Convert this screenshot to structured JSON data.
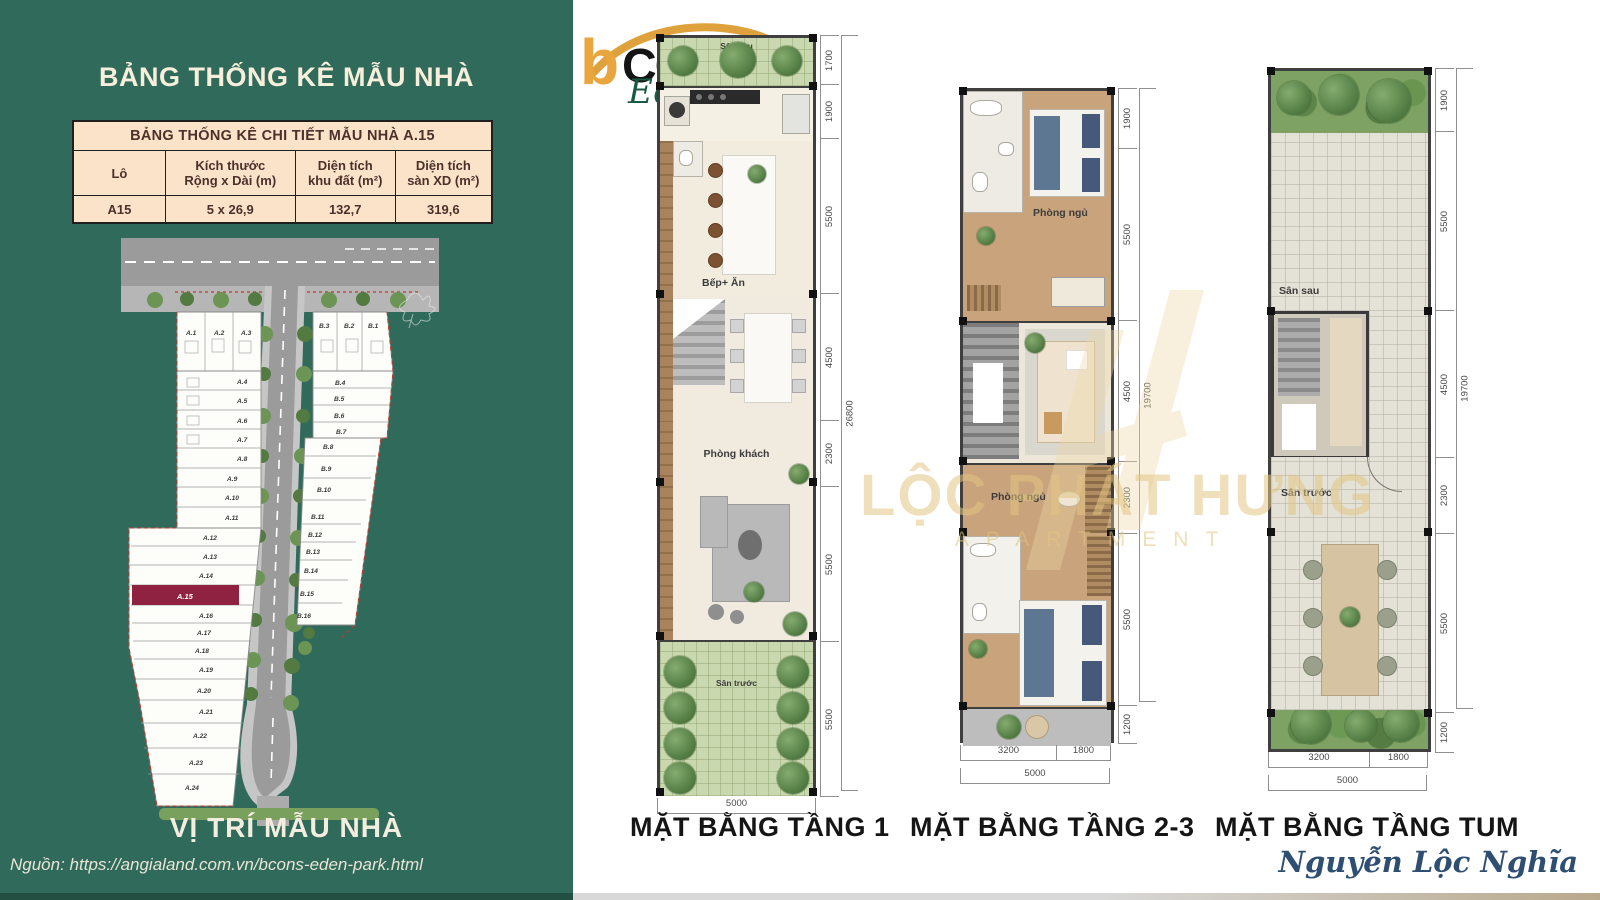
{
  "header": {
    "title": "BẢNG THỐNG KÊ MẪU NHÀ"
  },
  "table": {
    "title": "BẢNG THỐNG KÊ CHI TIẾT MẪU NHÀ A.15",
    "headers": [
      "Lô",
      "Kích thước\nRộng x Dài (m)",
      "Diện tích\nkhu đất (m²)",
      "Diện tích\nsàn XD (m²)"
    ],
    "row": [
      "A15",
      "5 x 26,9",
      "132,7",
      "319,6"
    ]
  },
  "siteplan": {
    "caption": "VỊ TRÍ MẪU NHÀ",
    "source": "Nguồn: https://angialand.com.vn/bcons-eden-park.html",
    "highlight_lot": "A.15",
    "highlight_color": "#8E2240",
    "lots_a": [
      "A.1",
      "A.2",
      "A.3",
      "A.4",
      "A.5",
      "A.6",
      "A.7",
      "A.8",
      "A.9",
      "A.10",
      "A.11",
      "A.12",
      "A.13",
      "A.14",
      "A.15",
      "A.16",
      "A.17",
      "A.18",
      "A.19",
      "A.20",
      "A.21",
      "A.22",
      "A.23",
      "A.24"
    ],
    "lots_b": [
      "B.1",
      "B.2",
      "B.3",
      "B.4",
      "B.5",
      "B.6",
      "B.7",
      "B.8",
      "B.9",
      "B.10",
      "B.11",
      "B.12",
      "B.13",
      "B.14",
      "B.15",
      "B.16"
    ]
  },
  "logo": {
    "b": "b",
    "name": "CONS",
    "subtitle": "Eden park"
  },
  "plans": [
    {
      "label": "MẶT BẰNG TẦNG 1",
      "rooms": {
        "san_sau": "Sân sau",
        "bep_an": "Bếp+ Ăn",
        "phong_khach": "Phòng khách",
        "san_truoc": "Sân trước"
      },
      "dims_right": [
        "1700",
        "1900",
        "5500",
        "4500",
        "2300",
        "5500",
        "5500"
      ],
      "dim_total": "26800",
      "dims_bottom": [
        "5000"
      ]
    },
    {
      "label": "MẶT BẰNG TẦNG 2-3",
      "rooms": {
        "phong_ngu_1": "Phòng ngủ",
        "phong_ngu_2": "Phòng ngủ"
      },
      "dims_right": [
        "1900",
        "5500",
        "4500",
        "2300",
        "5500",
        "1200"
      ],
      "dim_total": "19700",
      "dims_bottom": [
        "3200",
        "1800"
      ],
      "dim_bottom_total": "5000"
    },
    {
      "label": "MẶT BẰNG TẦNG TUM",
      "rooms": {
        "san_sau": "Sân sau",
        "san_truoc": "Sân trước"
      },
      "dims_right": [
        "1900",
        "5500",
        "4500",
        "2300",
        "5500",
        "1200"
      ],
      "dim_total": "19700",
      "dims_bottom": [
        "3200",
        "1800"
      ],
      "dim_bottom_total": "5000"
    }
  ],
  "watermark": {
    "line1": "LỘC PHÁT HƯNG",
    "line2": "APARTMENT"
  },
  "signature": "Nguyễn Lộc Nghĩa"
}
